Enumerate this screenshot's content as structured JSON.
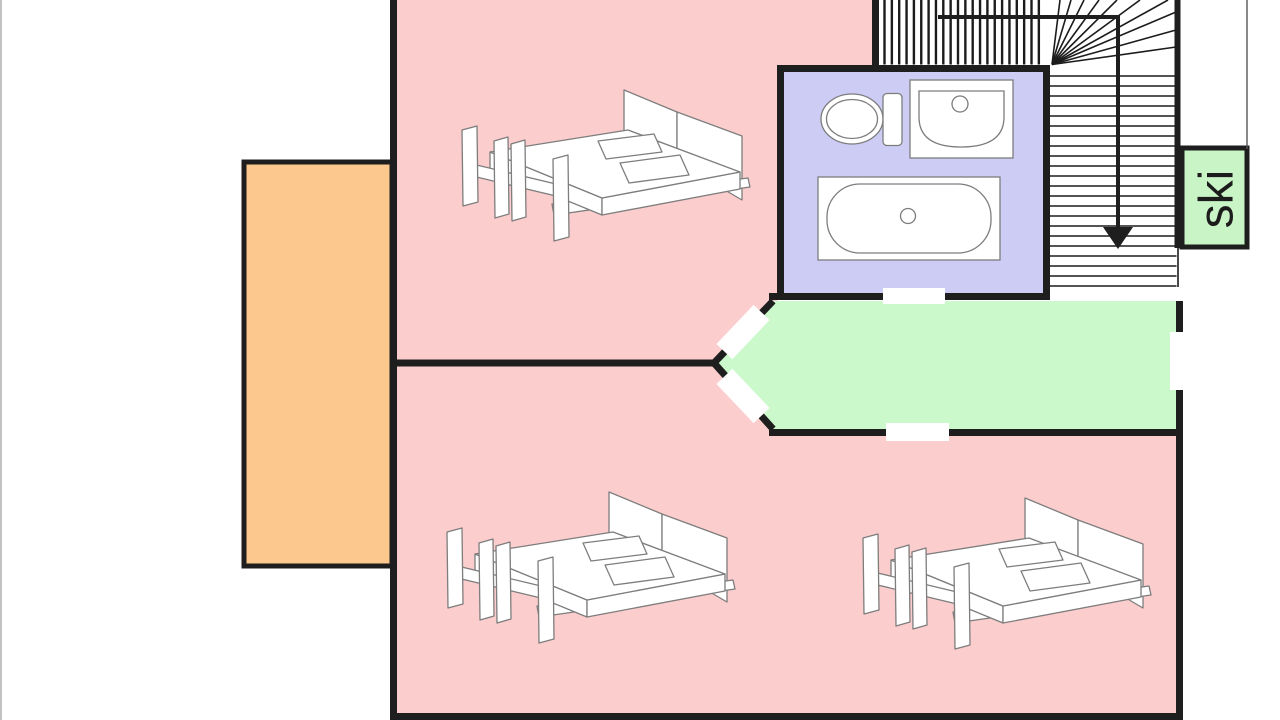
{
  "labels": {
    "ski": "ski"
  },
  "colors": {
    "bedroom": "#fccdcd",
    "bathroom": "#ccccf4",
    "hallway": "#ccf9cc",
    "balcony": "#fcc88e",
    "ski_box": "#c9f4c6",
    "wall": "#1e1e1e",
    "stair_line": "#1c1c1c",
    "fixture_stroke": "#7d7d7d",
    "door": "#ffffff",
    "text": "#1c1c1c"
  }
}
